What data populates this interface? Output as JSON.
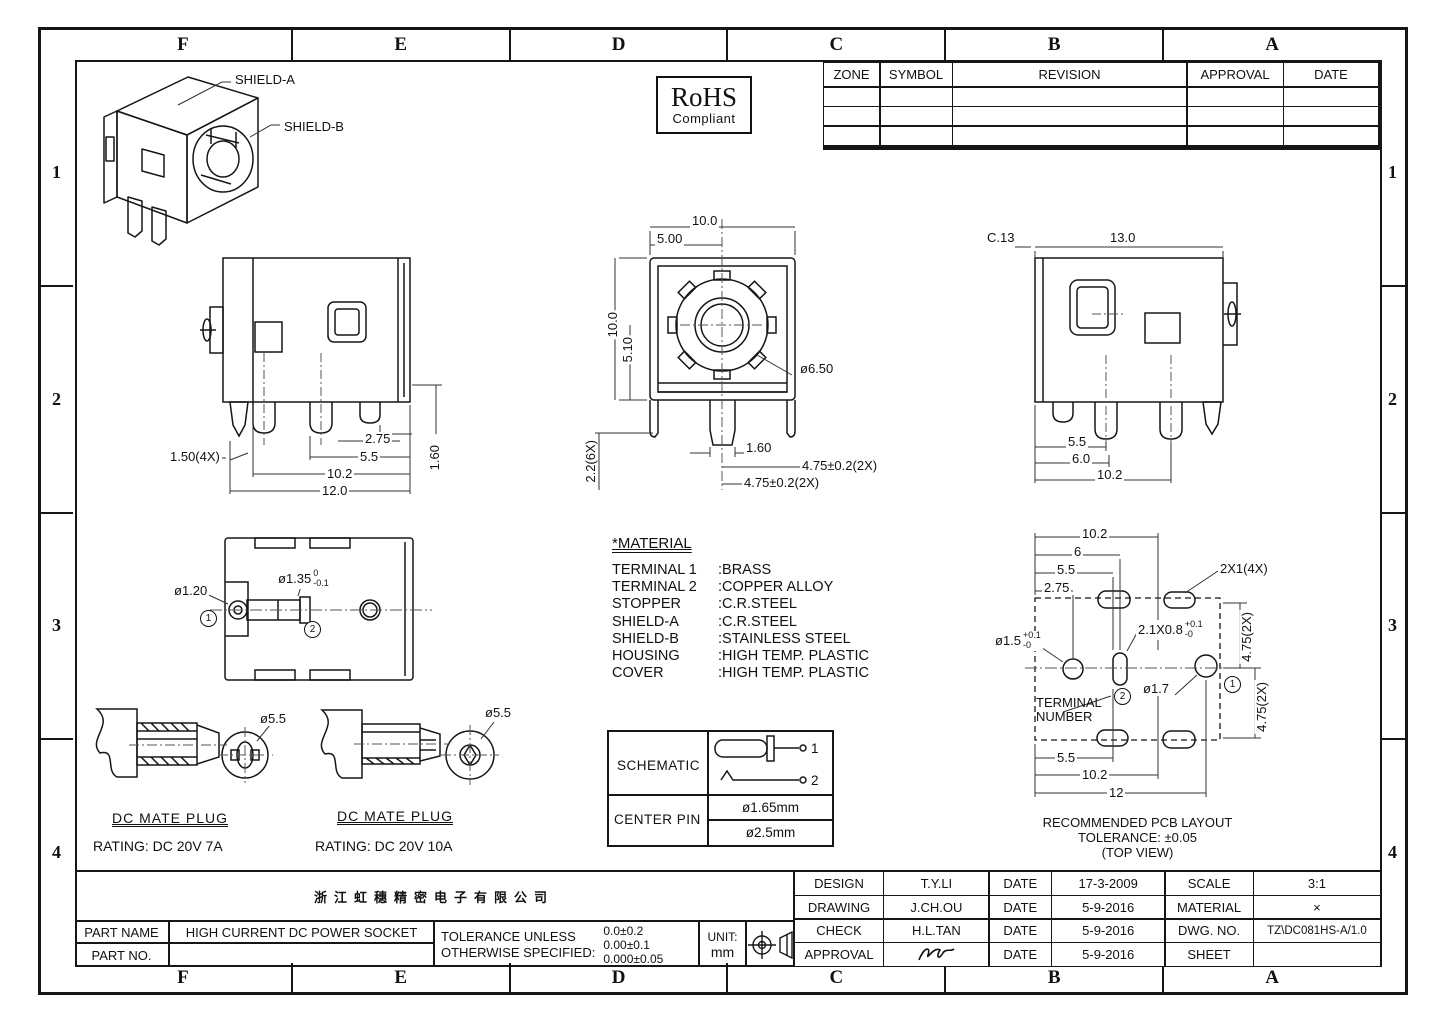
{
  "frame": {
    "cols": [
      "F",
      "E",
      "D",
      "C",
      "B",
      "A"
    ],
    "rows": [
      "1",
      "2",
      "3",
      "4"
    ]
  },
  "rohs": {
    "title": "RoHS",
    "subtitle": "Compliant"
  },
  "revision_table": {
    "headers": [
      "ZONE",
      "SYMBOL",
      "REVISION",
      "APPROVAL",
      "DATE"
    ]
  },
  "iso": {
    "shield_a": "SHIELD-A",
    "shield_b": "SHIELD-B"
  },
  "left_view": {
    "d1": "1.50(4X)",
    "d2": "2.75",
    "d3": "5.5",
    "d4": "10.2",
    "d5": "12.0",
    "d6": "1.60"
  },
  "front_view": {
    "d1": "10.0",
    "d2": "5.00",
    "d3": "10.0",
    "d4": "5.10",
    "d5": "ø6.50",
    "d6": "1.60",
    "d7": "4.75±0.2(2X)",
    "d8": "4.75±0.2(2X)",
    "d9": "2.2(6X)"
  },
  "right_view": {
    "d1": "C.13",
    "d2": "13.0",
    "d3": "5.5",
    "d4": "6.0",
    "d5": "10.2"
  },
  "bottom_view": {
    "d1": "ø1.20",
    "d2": "ø1.35",
    "d2_top": "0",
    "d2_bot": "-0.1",
    "t1": "1",
    "t2": "2"
  },
  "material": {
    "title": "*MATERIAL",
    "rows": [
      {
        "name": "TERMINAL 1",
        "value": ":BRASS"
      },
      {
        "name": "TERMINAL 2",
        "value": ":COPPER ALLOY"
      },
      {
        "name": "STOPPER",
        "value": ":C.R.STEEL"
      },
      {
        "name": "SHIELD-A",
        "value": ":C.R.STEEL"
      },
      {
        "name": "SHIELD-B",
        "value": ":STAINLESS STEEL"
      },
      {
        "name": "HOUSING",
        "value": ":HIGH TEMP. PLASTIC"
      },
      {
        "name": "COVER",
        "value": ":HIGH TEMP. PLASTIC"
      }
    ]
  },
  "plug_left": {
    "dia": "ø5.5",
    "title": "DC MATE PLUG",
    "rating": "RATING: DC 20V 7A"
  },
  "plug_right": {
    "dia": "ø5.5",
    "title": "DC MATE PLUG",
    "rating": "RATING: DC 20V 10A"
  },
  "schematic": {
    "row1": "SCHEMATIC",
    "row2": "CENTER PIN",
    "pin1": "1",
    "pin2": "2",
    "v1": "ø1.65mm",
    "v2": "ø2.5mm"
  },
  "pcb": {
    "d_top1": "10.2",
    "d_top2": "6",
    "d_top3": "5.5",
    "d_top4": "2.75",
    "d_pad": "2X1(4X)",
    "d_hole": "ø1.5",
    "d_hole_top": "+0.1",
    "d_hole_bot": "-0",
    "d_slot": "2.1X0.8",
    "d_slot_top": "+0.1",
    "d_slot_bot": "-0",
    "d_hole2": "ø1.7",
    "d_v1": "4.75(2X)",
    "d_v2": "4.75(2X)",
    "term1": "TERMINAL",
    "term2": "NUMBER",
    "t1": "1",
    "t2": "2",
    "d_bot1": "5.5",
    "d_bot2": "10.2",
    "d_bot3": "12",
    "cap1": "RECOMMENDED PCB LAYOUT",
    "cap2": "TOLERANCE: ±0.05",
    "cap3": "(TOP VIEW)"
  },
  "title_block": {
    "company": "浙江虹穗精密电子有限公司",
    "part_name_label": "PART NAME",
    "part_name": "HIGH CURRENT DC POWER SOCKET",
    "part_no_label": "PART NO.",
    "part_no": "",
    "tol_l1": "TOLERANCE UNLESS",
    "tol_l2": "OTHERWISE SPECIFIED:",
    "tol_v1": "0.0±0.2",
    "tol_v2": "0.00±0.1",
    "tol_v3": "0.000±0.05",
    "unit_label": "UNIT:",
    "unit_value": "mm",
    "rows": [
      {
        "label": "DESIGN",
        "name": "T.Y.LI",
        "date_label": "DATE",
        "date": "17-3-2009",
        "label2": "SCALE",
        "value2": "3:1"
      },
      {
        "label": "DRAWING",
        "name": "J.CH.OU",
        "date_label": "DATE",
        "date": "5-9-2016",
        "label2": "MATERIAL",
        "value2": "×"
      },
      {
        "label": "CHECK",
        "name": "H.L.TAN",
        "date_label": "DATE",
        "date": "5-9-2016",
        "label2": "DWG. NO.",
        "value2": "TZ\\DC081HS-A/1.0"
      },
      {
        "label": "APPROVAL",
        "name": "",
        "date_label": "DATE",
        "date": "5-9-2016",
        "label2": "SHEET",
        "value2": ""
      }
    ]
  }
}
